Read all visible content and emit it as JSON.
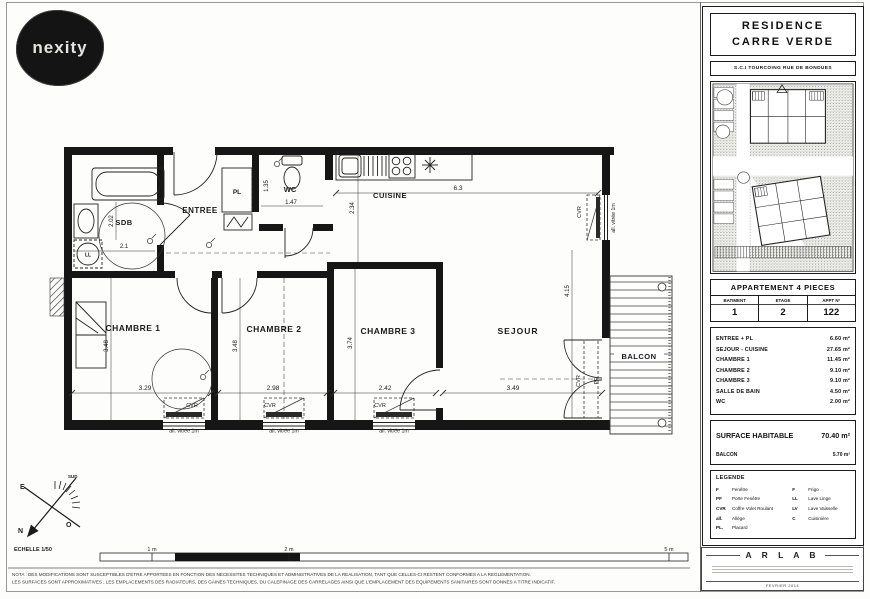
{
  "logo": {
    "text": "nexity"
  },
  "panel": {
    "residence_line1": "RESIDENCE",
    "residence_line2": "CARRE VERDE",
    "sci": "S.C.I TOURCOING RUE DE BONDUES",
    "apartment": {
      "title": "APPARTEMENT 4 PIECES",
      "col1": "BATIMENT",
      "col2": "ETAGE",
      "col3": "APPT N°",
      "val1": "1",
      "val2": "2",
      "val3": "122"
    },
    "areas": [
      {
        "label": "ENTREE + PL",
        "value": "6.60 m²"
      },
      {
        "label": "SEJOUR - CUISINE",
        "value": "27.65 m²"
      },
      {
        "label": "CHAMBRE 1",
        "value": "11.45 m²"
      },
      {
        "label": "CHAMBRE 2",
        "value": "9.10 m²"
      },
      {
        "label": "CHAMBRE 3",
        "value": "9.10 m²"
      },
      {
        "label": "SALLE DE BAIN",
        "value": "4.50 m²"
      },
      {
        "label": "WC",
        "value": "2.00 m²"
      }
    ],
    "surface_label": "SURFACE HABITABLE",
    "surface_value": "70.40 m²",
    "balcon_label": "BALCON",
    "balcon_value": "5.70 m²",
    "legend": {
      "title": "LEGENDE",
      "left": [
        {
          "abbr": "F",
          "label": "Fenêtre"
        },
        {
          "abbr": "PF",
          "label": "Porte Fenêtre"
        },
        {
          "abbr": "CVR",
          "label": "Coffre Volet Roulant"
        },
        {
          "abbr": "all.",
          "label": "Allège"
        },
        {
          "abbr": "PL.",
          "label": "Placard"
        }
      ],
      "right": [
        {
          "abbr": "F",
          "label": "Frigo"
        },
        {
          "abbr": "LL",
          "label": "Lave Linge"
        },
        {
          "abbr": "LV",
          "label": "Lave Vaisselle"
        },
        {
          "abbr": "C",
          "label": "Cuisinière"
        }
      ]
    },
    "firm": "A R L A B",
    "date": "FEVRIER 2014"
  },
  "plan": {
    "labels": {
      "sdb": "SDB",
      "entree": "ENTREE",
      "pl": "PL",
      "wc": "WC",
      "cuisine": "CUISINE",
      "ch1": "CHAMBRE 1",
      "ch2": "CHAMBRE 2",
      "ch3": "CHAMBRE 3",
      "sejour": "SEJOUR",
      "balcon": "BALCON",
      "ll": "LL",
      "cvr": "CVR",
      "pf": "PF",
      "allege": "all. vitrée 1m"
    },
    "dims": {
      "sdb_w": "2.1",
      "sdb_h": "2.02",
      "wc_w": "1.47",
      "wc_h": "1.35",
      "cuisine_w": "6.3",
      "cuisine_h": "2.34",
      "ch1_w": "3.29",
      "ch1_h": "3.48",
      "ch2_w": "2.98",
      "ch2_h": "3.48",
      "ch3_w": "2.42",
      "ch3_h": "3.74",
      "sejour_w": "3.49",
      "sejour_h": "4.15"
    }
  },
  "compass": {
    "n": "N",
    "e": "E",
    "o": "O",
    "sud": "SUD"
  },
  "scalebar": {
    "echelle": "ECHELLE 1/50",
    "m1": "1 m",
    "m2": "2 m",
    "m5": "5 m"
  },
  "footer": {
    "nota1": "NOTA : DES MODIFICATIONS SONT SUSCEPTIBLES D'ETRE APPORTEES EN FONCTION DES NECESSITES TECHNIQUES ET ADMINISTRATIVES DE LA REALISATION, TANT QUE CELLES-CI RESTENT CONFORMES A LA REGLEMENTATION.",
    "nota2": "LES SURFACES SONT APPROXIMATIVES ; LES EMPLACEMENTS DES RADIATEURS, DES GAINES TECHNIQUES, DU CALEPINAGE DES CARRELAGES AINSI QUE L'EMPLACEMENT DES EQUIPEMENTS SANITAIRES SONT DONNES A TITRE INDICATIF."
  }
}
